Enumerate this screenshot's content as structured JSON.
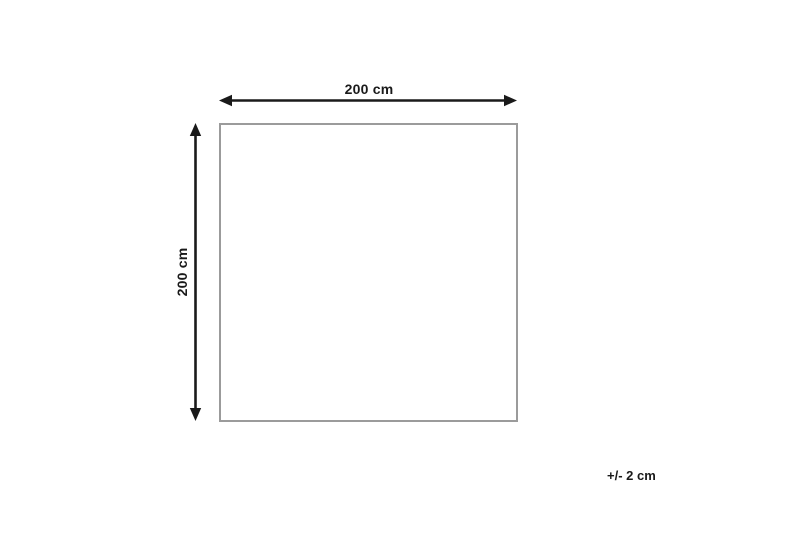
{
  "diagram": {
    "type": "dimension-diagram",
    "shape": "square",
    "width_label": "200 cm",
    "height_label": "200 cm",
    "tolerance_label": "+/- 2 cm",
    "width_value_cm": 200,
    "height_value_cm": 200,
    "tolerance_value_cm": 2
  },
  "colors": {
    "background": "#ffffff",
    "arrow": "#1a1a1a",
    "square_border": "#9b9b9b",
    "text": "#1a1a1a"
  }
}
